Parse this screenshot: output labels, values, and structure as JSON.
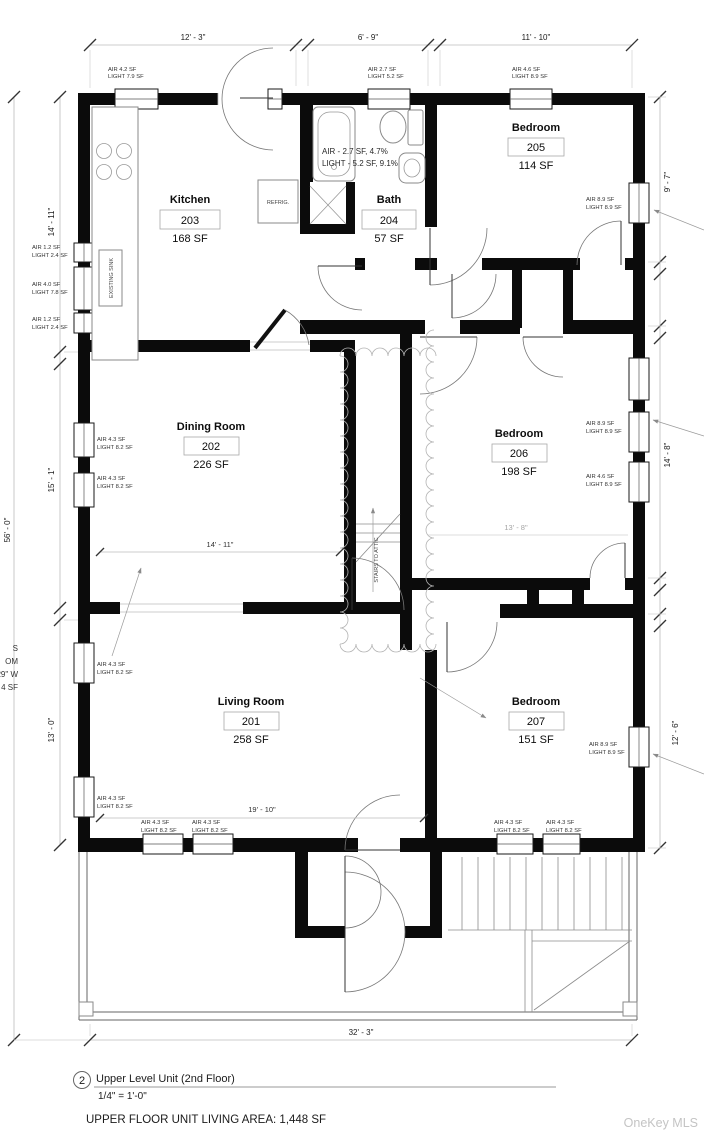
{
  "drawing": {
    "rooms": [
      {
        "name": "Kitchen",
        "number": "203",
        "area": "168 SF"
      },
      {
        "name": "Bath",
        "number": "204",
        "area": "57 SF"
      },
      {
        "name": "Bedroom",
        "number": "205",
        "area": "114 SF"
      },
      {
        "name": "Dining Room",
        "number": "202",
        "area": "226 SF"
      },
      {
        "name": "Bedroom",
        "number": "206",
        "area": "198 SF"
      },
      {
        "name": "Living Room",
        "number": "201",
        "area": "258 SF"
      },
      {
        "name": "Bedroom",
        "number": "207",
        "area": "151 SF"
      }
    ],
    "window_labels": [
      {
        "air": "AIR 4.2 SF",
        "light": "LIGHT 7.9 SF"
      },
      {
        "air": "AIR 2.7 SF",
        "light": "LIGHT 5.2 SF"
      },
      {
        "air": "AIR 4.6 SF",
        "light": "LIGHT 8.9 SF"
      },
      {
        "air": "AIR 1.2 SF",
        "light": "LIGHT 2.4 SF"
      },
      {
        "air": "AIR 4.0 SF",
        "light": "LIGHT 7.8 SF"
      },
      {
        "air": "AIR 1.2 SF",
        "light": "LIGHT 2.4 SF"
      },
      {
        "air": "AIR 4.3 SF",
        "light": "LIGHT 8.2 SF"
      },
      {
        "air": "AIR 4.3 SF",
        "light": "LIGHT 8.2 SF"
      },
      {
        "air": "AIR 4.3 SF",
        "light": "LIGHT 8.2 SF"
      },
      {
        "air": "AIR 4.3 SF",
        "light": "LIGHT 8.2 SF"
      },
      {
        "air": "AIR 8.9 SF",
        "light": "LIGHT 8.9 SF"
      },
      {
        "air": "AIR 8.9 SF",
        "light": "LIGHT 8.9 SF"
      },
      {
        "air": "AIR 4.6 SF",
        "light": "LIGHT 8.9 SF"
      },
      {
        "air": "AIR 8.9 SF",
        "light": "LIGHT 8.9 SF"
      },
      {
        "air": "AIR 4.3 SF",
        "light": "LIGHT 8.2 SF"
      },
      {
        "air": "AIR 4.3 SF",
        "light": "LIGHT 8.2 SF"
      },
      {
        "air": "AIR 4.3 SF",
        "light": "LIGHT 8.2 SF"
      },
      {
        "air": "AIR 4.3 SF",
        "light": "LIGHT 8.2 SF"
      }
    ],
    "bath_note": {
      "line1": "AIR - 2.7 SF, 4.7%",
      "line2": "LIGHT - 5.2 SF, 9.1%"
    },
    "dimensions": {
      "top_kitchen": "12' - 3\"",
      "top_bath": "6' - 9\"",
      "top_bedroom": "11' - 10\"",
      "left_kitchen": "14' - 11\"",
      "left_dining": "15' - 1\"",
      "left_living": "13' - 0\"",
      "left_overall": "56' - 0\"",
      "right_bedroom205": "9' - 7\"",
      "right_bedroom206": "14' - 8\"",
      "right_bedroom207": "12' - 6\"",
      "bottom_overall": "32' - 3\"",
      "dining_width": "14' - 11\"",
      "living_width": "19' - 10\"",
      "bedroom206_width": "13' - 8\""
    },
    "fixtures": {
      "refrigerator": "REFRIG.",
      "sink": "EXISTING SINK",
      "attic_stairs": "STAIRS TO ATTIC"
    },
    "edge_text": {
      "line1": "S",
      "line2": "OM",
      "line3": "29\" W",
      "line4": "4 SF"
    }
  },
  "title_block": {
    "number": "2",
    "title": "Upper Level Unit (2nd Floor)",
    "scale": "1/4\" = 1'-0\"",
    "area_note": "UPPER FLOOR UNIT LIVING AREA: 1,448 SF"
  },
  "watermark": "OneKey MLS"
}
